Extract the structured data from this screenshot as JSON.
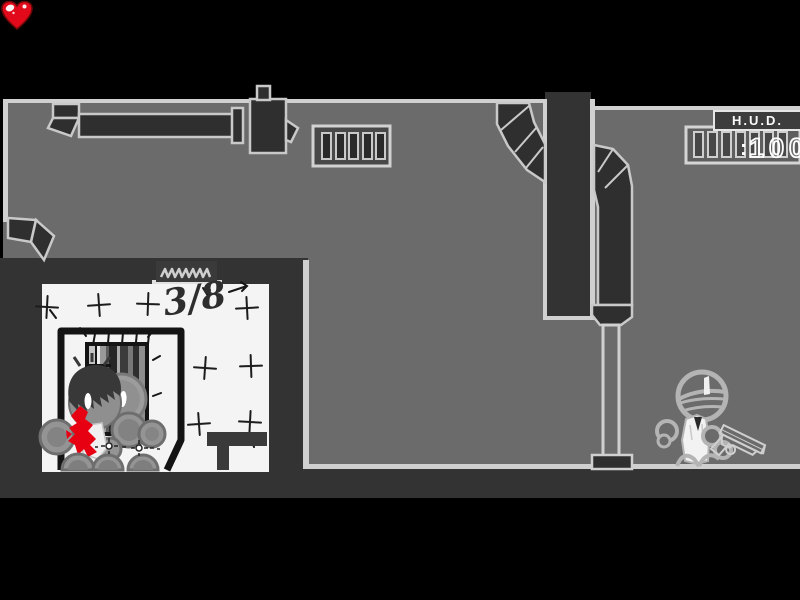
{
  "hud": {
    "title": "H.U.D.",
    "health": {
      "icon": "heart-icon",
      "separator": ":",
      "value": "100",
      "heart_color": "#e20a1a"
    }
  },
  "level": {
    "progress_label": "3/8"
  },
  "colors": {
    "letterbox": "#000000",
    "wall": "#6b6b6b",
    "dark_structure": "#333333",
    "duct_fill": "#2f2f2f",
    "outline_light": "#d0d0d0",
    "room_wall": "#f4f4f4",
    "ink": "#1c1c1c",
    "blood": "#e60012",
    "enemy_outline": "#b4b4b4",
    "vest_white": "#f2f2f2"
  }
}
